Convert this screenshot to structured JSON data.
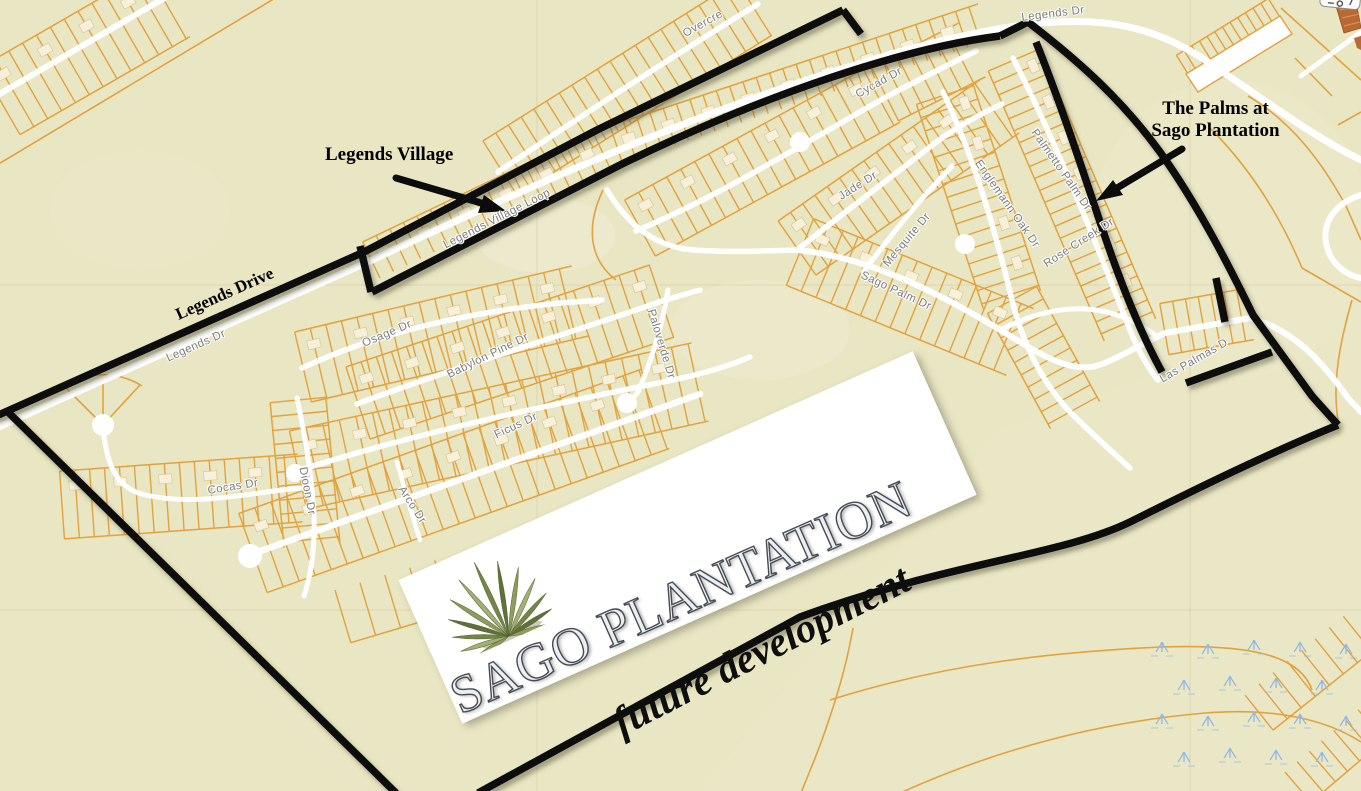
{
  "title": "Sago Plantation development map",
  "map": {
    "background_color": "#e9e6c3",
    "parcel_line_color": "#e2a23f",
    "road_color": "#ffffff",
    "boundary_color": "#0d0d0d",
    "street_label_color": "#7b7b78",
    "marsh_color": "#8fb9e6",
    "street_labels": [
      "Legends Dr",
      "Legends Village Loop",
      "Overcre",
      "Legends Dr",
      "Cycad Dr",
      "Jade Dr",
      "Mesquite Dr",
      "Sago Palm Dr",
      "Englemann Oak Dr",
      "Palmetto Palm Dr",
      "Rose Creek Dr",
      "Las Palmas D",
      "Osage Dr",
      "Babylon Pine Dr",
      "Paloverde Dr",
      "Ficus Dr",
      "Cocas Dr",
      "Dioon Dr",
      "Arco Dr"
    ],
    "annotations": {
      "legends_village": "Legends Village",
      "palms_line1": "The Palms at",
      "palms_line2": "Sago Plantation",
      "legends_drive": "Legends Drive"
    },
    "banner": {
      "brand": "SAGO PLANTATION",
      "tagline": "future development",
      "logo": "palm-frond-icon",
      "logo_colors": [
        "#8e9c5e",
        "#a3b075",
        "#75854a",
        "#5f7038"
      ]
    }
  }
}
